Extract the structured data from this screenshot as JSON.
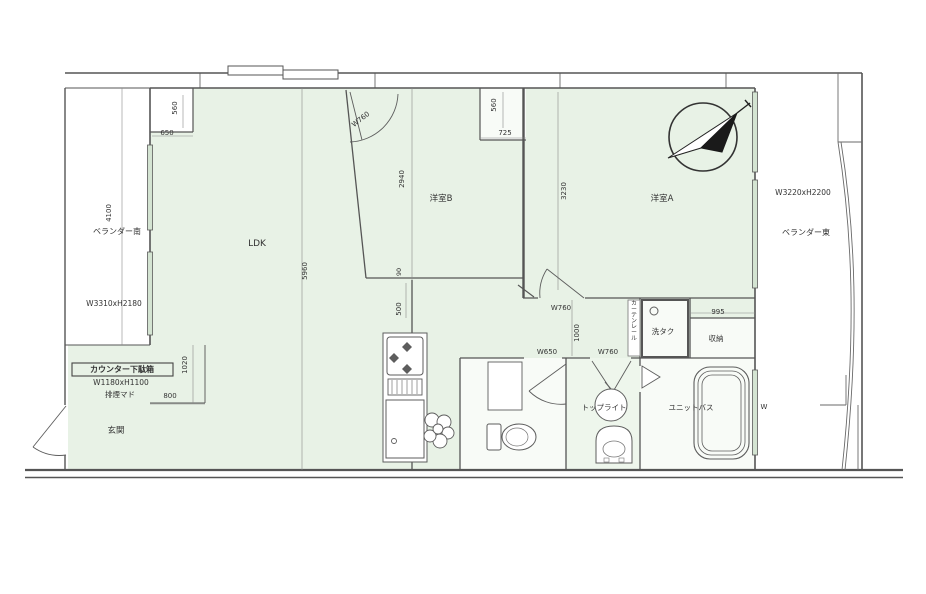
{
  "meta": {
    "type": "floor-plan",
    "description": "Japanese apartment floor plan (madori) with LDK, two western rooms, unit bath and two balconies",
    "room_fill_color": "#e8f2e6",
    "wet_room_fill_color": "#f8fbf7",
    "wall_color": "#555555",
    "compass": {
      "direction": "NE"
    }
  },
  "rooms": [
    "LDK",
    "洋室B",
    "洋室A",
    "玄関",
    "ユニットバス",
    "洗タク",
    "収納",
    "トップライト",
    "ベランダー南",
    "ベランダー東"
  ],
  "fixtures": [
    "compass",
    "kitchen-stove",
    "kitchen-cabinet",
    "plant",
    "toilet",
    "washbasin",
    "vanity",
    "bathtub",
    "laundry-tap",
    "entrance-door",
    "bath-folding-door"
  ],
  "labels": [
    {
      "name": "dim-560-left-notch",
      "text": "560",
      "x": 177,
      "y": 108,
      "rot": -90,
      "size": 7
    },
    {
      "name": "dim-650-left-notch",
      "text": "650",
      "x": 167,
      "y": 135,
      "size": 7
    },
    {
      "name": "dim-4100",
      "text": "4100",
      "x": 111,
      "y": 213,
      "rot": -90,
      "size": 7
    },
    {
      "name": "label-balcony-left",
      "text": "ベランダー南",
      "x": 117,
      "y": 234,
      "size": 8
    },
    {
      "name": "label-balcony-left-size",
      "text": "W3310xH2180",
      "x": 114,
      "y": 306,
      "size": 7.5
    },
    {
      "name": "label-counter-shoebox",
      "text": "カウンター下駄箱",
      "x": 122,
      "y": 372,
      "size": 8,
      "bold": true
    },
    {
      "name": "label-counter-shoebox-size",
      "text": "W1180xH1100",
      "x": 121,
      "y": 385,
      "size": 7.5
    },
    {
      "name": "label-haien-mado",
      "text": "排煙マド",
      "x": 120,
      "y": 397,
      "size": 7.5
    },
    {
      "name": "label-genkan",
      "text": "玄関",
      "x": 116,
      "y": 433,
      "size": 8.5
    },
    {
      "name": "dim-1020",
      "text": "1020",
      "x": 187,
      "y": 365,
      "rot": -90,
      "size": 7
    },
    {
      "name": "dim-800",
      "text": "800",
      "x": 170,
      "y": 398,
      "size": 7
    },
    {
      "name": "label-ldk",
      "text": "LDK",
      "x": 257,
      "y": 246,
      "size": 9
    },
    {
      "name": "dim-5960",
      "text": "5960",
      "x": 307,
      "y": 271,
      "rot": -90,
      "size": 7
    },
    {
      "name": "dim-w760-roomB-door",
      "text": "W760",
      "x": 362,
      "y": 121,
      "rot": -38,
      "size": 7
    },
    {
      "name": "dim-2940",
      "text": "2940",
      "x": 404,
      "y": 179,
      "rot": -90,
      "size": 7
    },
    {
      "name": "label-room-b",
      "text": "洋室B",
      "x": 441,
      "y": 201,
      "size": 8.5
    },
    {
      "name": "dim-560-closet",
      "text": "560",
      "x": 496,
      "y": 105,
      "rot": -90,
      "size": 7
    },
    {
      "name": "dim-725",
      "text": "725",
      "x": 505,
      "y": 135,
      "size": 7
    },
    {
      "name": "dim-90",
      "text": "90",
      "x": 401,
      "y": 272,
      "rot": -90,
      "size": 6.5
    },
    {
      "name": "dim-500",
      "text": "500",
      "x": 401,
      "y": 309,
      "rot": -90,
      "size": 7
    },
    {
      "name": "dim-3230",
      "text": "3230",
      "x": 566,
      "y": 191,
      "rot": -90,
      "size": 7
    },
    {
      "name": "label-room-a",
      "text": "洋室A",
      "x": 662,
      "y": 201,
      "size": 8.5
    },
    {
      "name": "label-balcony-right-size",
      "text": "W3220xH2200",
      "x": 803,
      "y": 195,
      "size": 7.5
    },
    {
      "name": "label-balcony-right",
      "text": "ベランダー東",
      "x": 806,
      "y": 235,
      "size": 8
    },
    {
      "name": "dim-w760-roomA-door",
      "text": "W760",
      "x": 561,
      "y": 310,
      "size": 7
    },
    {
      "name": "dim-1000",
      "text": "1000",
      "x": 579,
      "y": 333,
      "rot": -90,
      "size": 7
    },
    {
      "name": "dim-w650-toilet-door",
      "text": "W650",
      "x": 547,
      "y": 354,
      "size": 7
    },
    {
      "name": "dim-w760-washroom-door",
      "text": "W760",
      "x": 608,
      "y": 354,
      "size": 7
    },
    {
      "name": "label-curtain-rail",
      "text": "カーテンレール",
      "x": 634,
      "y": 305,
      "size": 5.8,
      "vertical": true
    },
    {
      "name": "label-sentaku",
      "text": "洗タク",
      "x": 663,
      "y": 334,
      "size": 7.5
    },
    {
      "name": "dim-995",
      "text": "995",
      "x": 718,
      "y": 314,
      "size": 7
    },
    {
      "name": "label-shuno",
      "text": "収納",
      "x": 716,
      "y": 341,
      "size": 7.5
    },
    {
      "name": "label-toplight",
      "text": "トップライト",
      "x": 604,
      "y": 410,
      "size": 7.5
    },
    {
      "name": "label-unit-bath",
      "text": "ユニットバス",
      "x": 691,
      "y": 410,
      "size": 7.5
    },
    {
      "name": "label-w-partial",
      "text": "W",
      "x": 764,
      "y": 409,
      "size": 7
    }
  ]
}
